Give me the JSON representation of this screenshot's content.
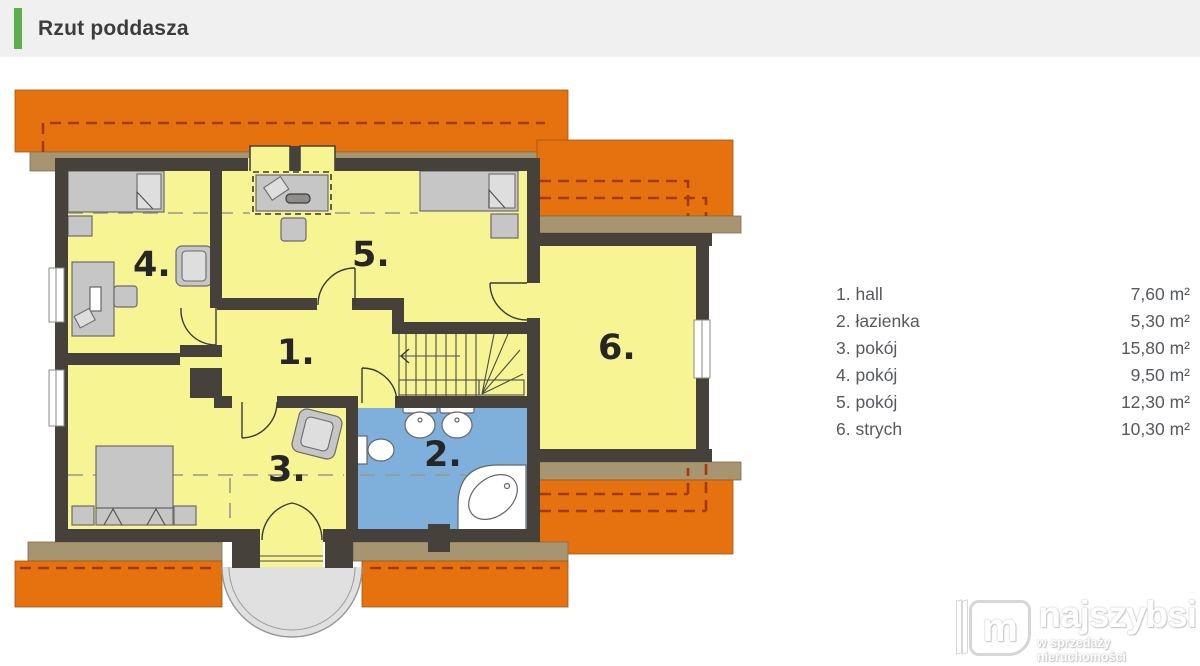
{
  "header": {
    "title": "Rzut poddasza",
    "accent_color": "#5cb04c"
  },
  "legend": {
    "items": [
      {
        "num": "1.",
        "name": "hall",
        "area": "7,60 m²"
      },
      {
        "num": "2.",
        "name": "łazienka",
        "area": "5,30 m²"
      },
      {
        "num": "3.",
        "name": "pokój",
        "area": "15,80 m²"
      },
      {
        "num": "4.",
        "name": "pokój",
        "area": "9,50 m²"
      },
      {
        "num": "5.",
        "name": "pokój",
        "area": "12,30 m²"
      },
      {
        "num": "6.",
        "name": "strych",
        "area": "10,30 m²"
      }
    ]
  },
  "floorplan": {
    "room_labels": {
      "r1": "1.",
      "r2": "2.",
      "r3": "3.",
      "r4": "4.",
      "r5": "5.",
      "r6": "6."
    },
    "colors": {
      "accent": "#5cb04c",
      "roof": "#e5720e",
      "roof_dash": "#a03a0c",
      "eave": "#a79471",
      "room": "#f7f494",
      "bath": "#7fb0dc",
      "wall": "#46413b",
      "furniture": "#c6c6c6",
      "balcony": "#e0e0e0"
    }
  },
  "watermark": {
    "brand": "najszybsi",
    "tagline": "w sprzedaży nieruchomości",
    "logo_letter": "m"
  }
}
